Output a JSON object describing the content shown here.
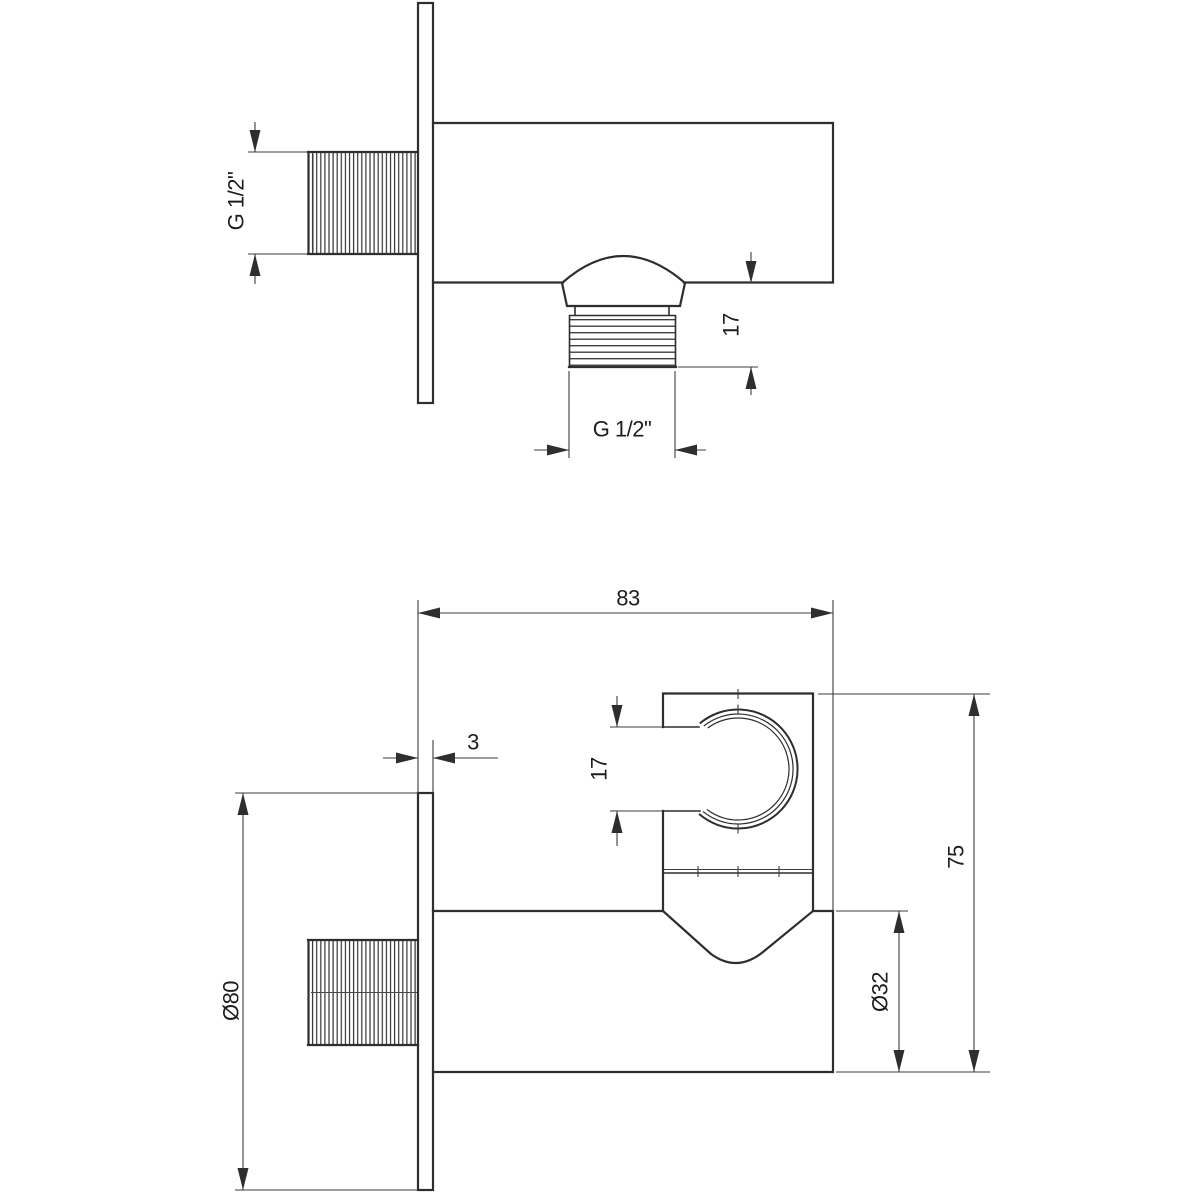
{
  "style": {
    "background": "#ffffff",
    "line_color": "#2e2e2e",
    "text_color": "#1d1d1d"
  },
  "dimensions": {
    "top_view": {
      "inlet_thread": "G 1/2\"",
      "outlet_thread_length": "17",
      "outlet_thread": "G 1/2\""
    },
    "bottom_view": {
      "total_depth": "83",
      "plate_thickness": "3",
      "holder_opening": "17",
      "plate_diameter": "Ø80",
      "body_diameter": "Ø32",
      "total_height": "75"
    }
  }
}
